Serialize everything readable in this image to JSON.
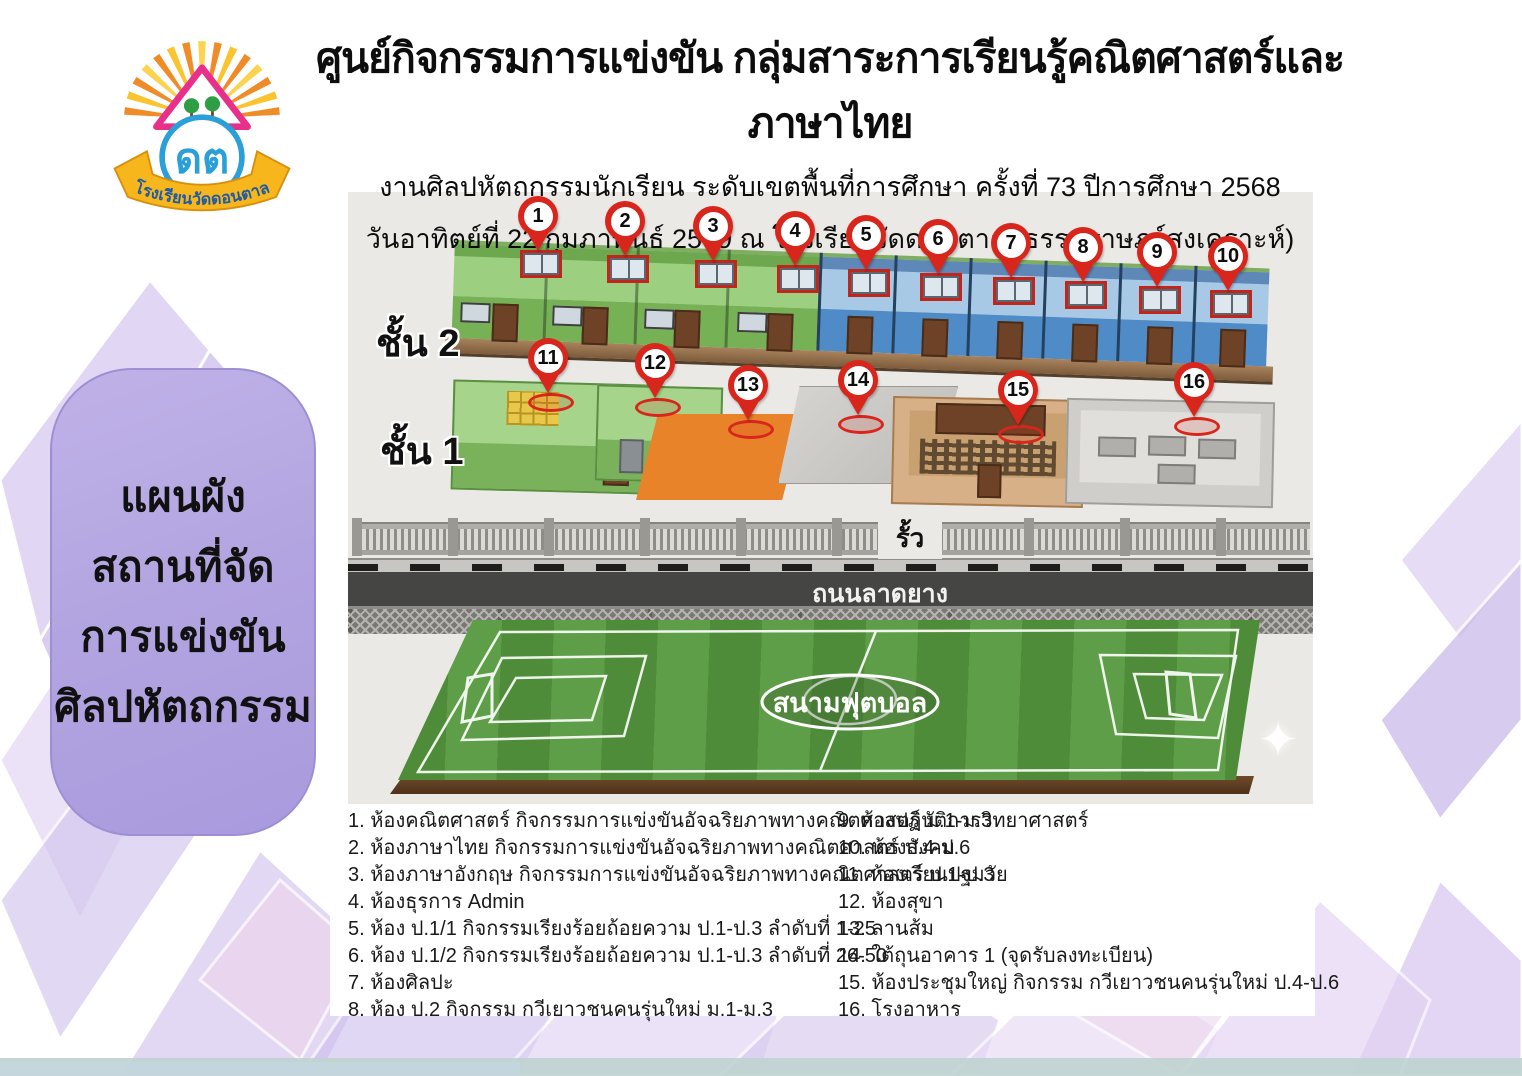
{
  "header": {
    "title": "ศูนย์กิจกรรมการแข่งขัน กลุ่มสาระการเรียนรู้คณิตศาสตร์และภาษาไทย",
    "subtitle1": "งานศิลปหัตถกรรมนักเรียน ระดับเขตพื้นที่การศึกษา ครั้งที่ 73 ปีการศึกษา 2568",
    "subtitle2": "วันอาทิตย์ที่ 22 กุมภาพันธ์ 2569 ณ โรงเรียนวัดดอนตาล (ธรรมราษฎร์สงเคราะห์)"
  },
  "logo": {
    "school_name": "โรงเรียนวัดดอนตาล",
    "emblem_letters": "ดต"
  },
  "sidebar": {
    "line1": "แผนผัง",
    "line2": "สถานที่จัด",
    "line3": "การแข่งขัน",
    "line4": "ศิลปหัตถกรรม"
  },
  "map": {
    "floor2_label": "ชั้น 2",
    "floor1_label": "ชั้น 1",
    "fence_label": "รั้ว",
    "road_label": "ถนนลาดยาง",
    "field_label": "สนามฟุตบอล",
    "pins": [
      "1",
      "2",
      "3",
      "4",
      "5",
      "6",
      "7",
      "8",
      "9",
      "10",
      "11",
      "12",
      "13",
      "14",
      "15",
      "16"
    ]
  },
  "legend": {
    "left": [
      {
        "num": "1.",
        "text": "ห้องคณิตศาสตร์ กิจกรรมการแข่งขันอัจฉริยภาพทางคณิตศาสตร์ ม.1-ม.3"
      },
      {
        "num": "2.",
        "text": "ห้องภาษาไทย กิจกรรมการแข่งขันอัจฉริยภาพทางคณิตศาสตร์ ป.4-ป.6"
      },
      {
        "num": "3.",
        "text": "ห้องภาษาอังกฤษ กิจกรรมการแข่งขันอัจฉริยภาพทางคณิตศาสตร์ ป.1-ป.3"
      },
      {
        "num": "4.",
        "text": "ห้องธุรการ Admin"
      },
      {
        "num": "5.",
        "text": "ห้อง ป.1/1 กิจกรรมเรียงร้อยถ้อยความ ป.1-ป.3 ลำดับที่ 1-25"
      },
      {
        "num": "6.",
        "text": "ห้อง ป.1/2 กิจกรรมเรียงร้อยถ้อยความ ป.1-ป.3 ลำดับที่ 26-50"
      },
      {
        "num": "7.",
        "text": "ห้องศิลปะ"
      },
      {
        "num": "8.",
        "text": "ห้อง ป.2 กิจกรรม กวีเยาวชนคนรุ่นใหม่ ม.1-ม.3"
      }
    ],
    "right": [
      {
        "num": "9.",
        "text": "ห้องปฏิบัติการวิทยาศาสตร์"
      },
      {
        "num": "10.",
        "text": "ห้องสังคม"
      },
      {
        "num": "11.",
        "text": "ห้องเรียนปฐมวัย"
      },
      {
        "num": "12.",
        "text": "ห้องสุขา"
      },
      {
        "num": "13.",
        "text": "ลานส้ม"
      },
      {
        "num": "14.",
        "text": "ใต้ถุนอาคาร 1 (จุดรับลงทะเบียน)"
      },
      {
        "num": "15.",
        "text": "ห้องประชุมใหญ่ กิจกรรม กวีเยาวชนคนรุ่นใหม่ ป.4-ป.6"
      },
      {
        "num": "16.",
        "text": "โรงอาหาร"
      }
    ]
  },
  "colors": {
    "pin_red": "#d8261c",
    "floor2_green": "#8fc971",
    "floor2_blue": "#5b9bd5",
    "terrace_orange": "#e8832a",
    "bubble_purple": "#b3a5e0",
    "field_green": "#528f3c",
    "road_gray": "#454543"
  }
}
